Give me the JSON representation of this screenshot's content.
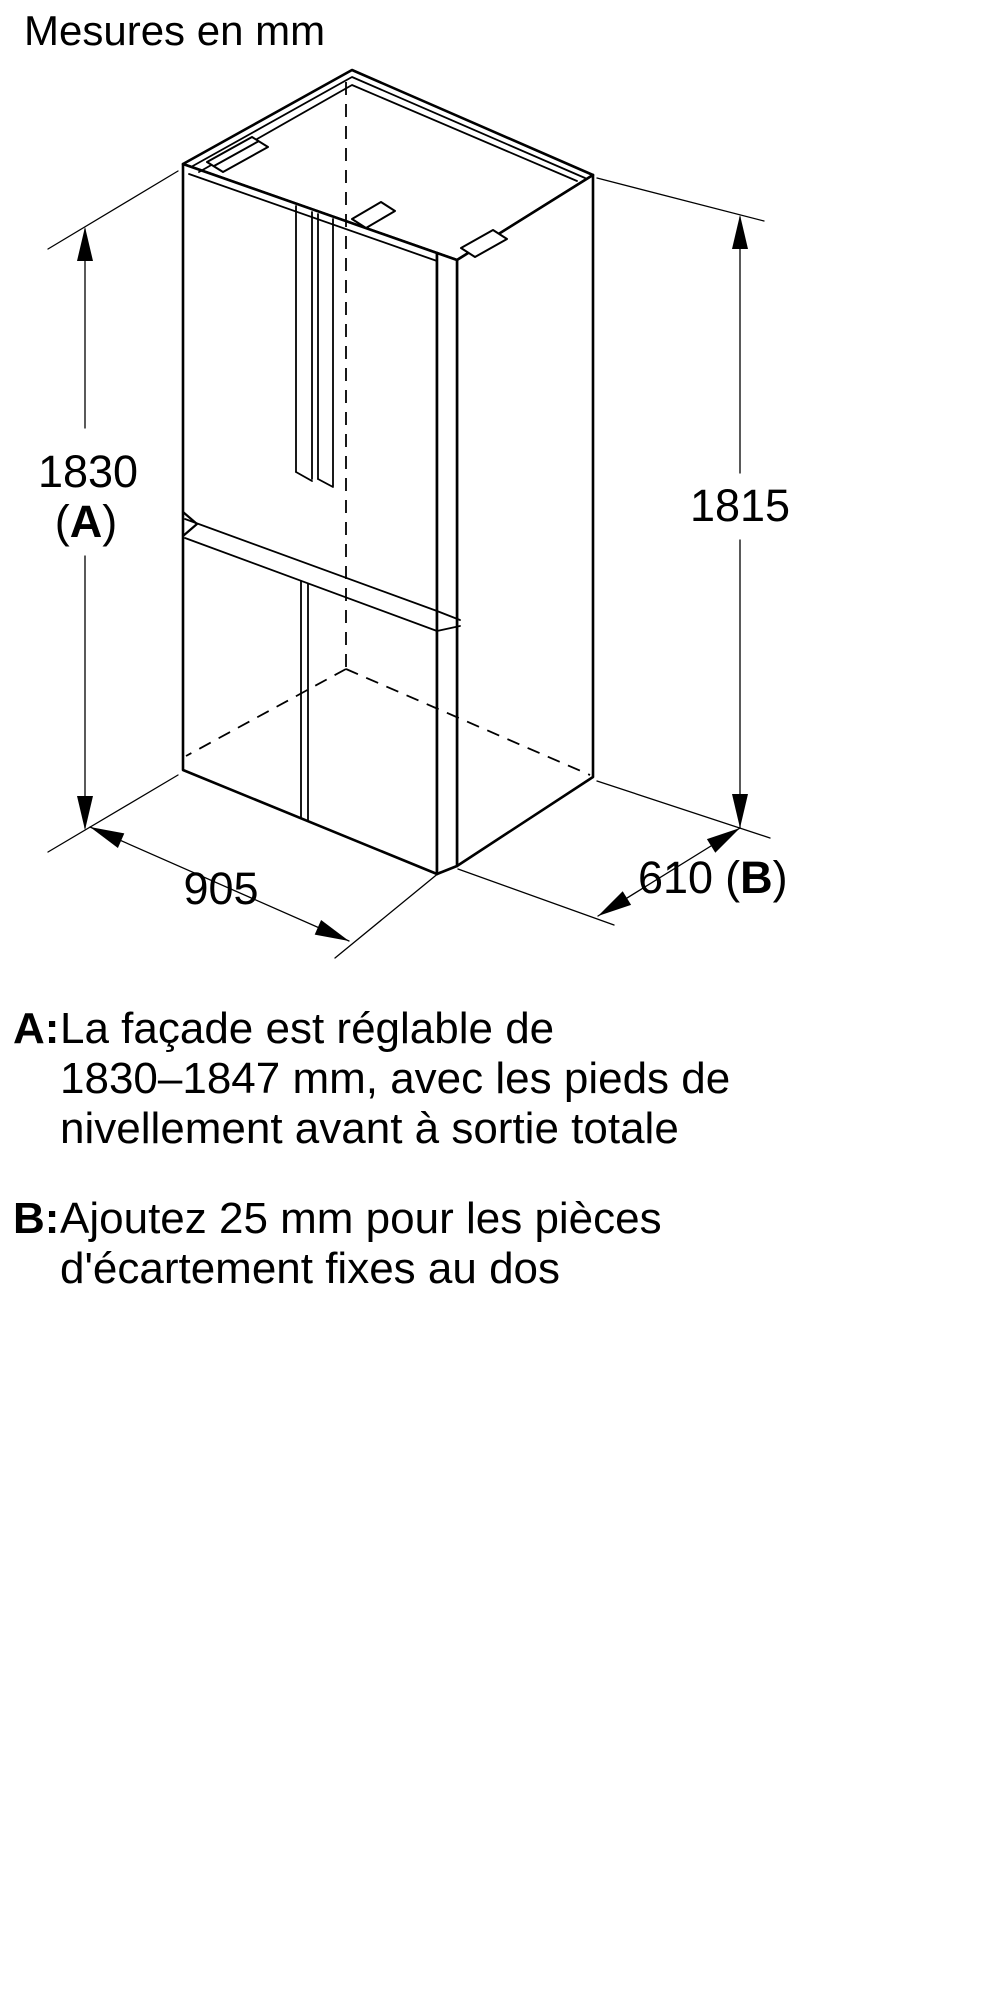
{
  "title": "Mesures en mm",
  "diagram": {
    "dim_height_front": {
      "value": "1830",
      "paren_open": "(",
      "letter": "A",
      "paren_close": ")"
    },
    "dim_height_back": {
      "value": "1815"
    },
    "dim_width": {
      "value": "905"
    },
    "dim_depth": {
      "value": "610",
      "paren_open": "(",
      "letter": "B",
      "paren_close": ")"
    }
  },
  "notes": [
    {
      "key": "A:",
      "lines": [
        "La façade est réglable de",
        "1830–1847 mm, avec les pieds de",
        "nivellement avant à sortie totale"
      ]
    },
    {
      "key": "B:",
      "lines": [
        "Ajoutez 25 mm pour les pièces",
        "d'écartement fixes au dos"
      ]
    }
  ],
  "colors": {
    "line": "#000000",
    "text": "#000000",
    "background": "#ffffff"
  }
}
